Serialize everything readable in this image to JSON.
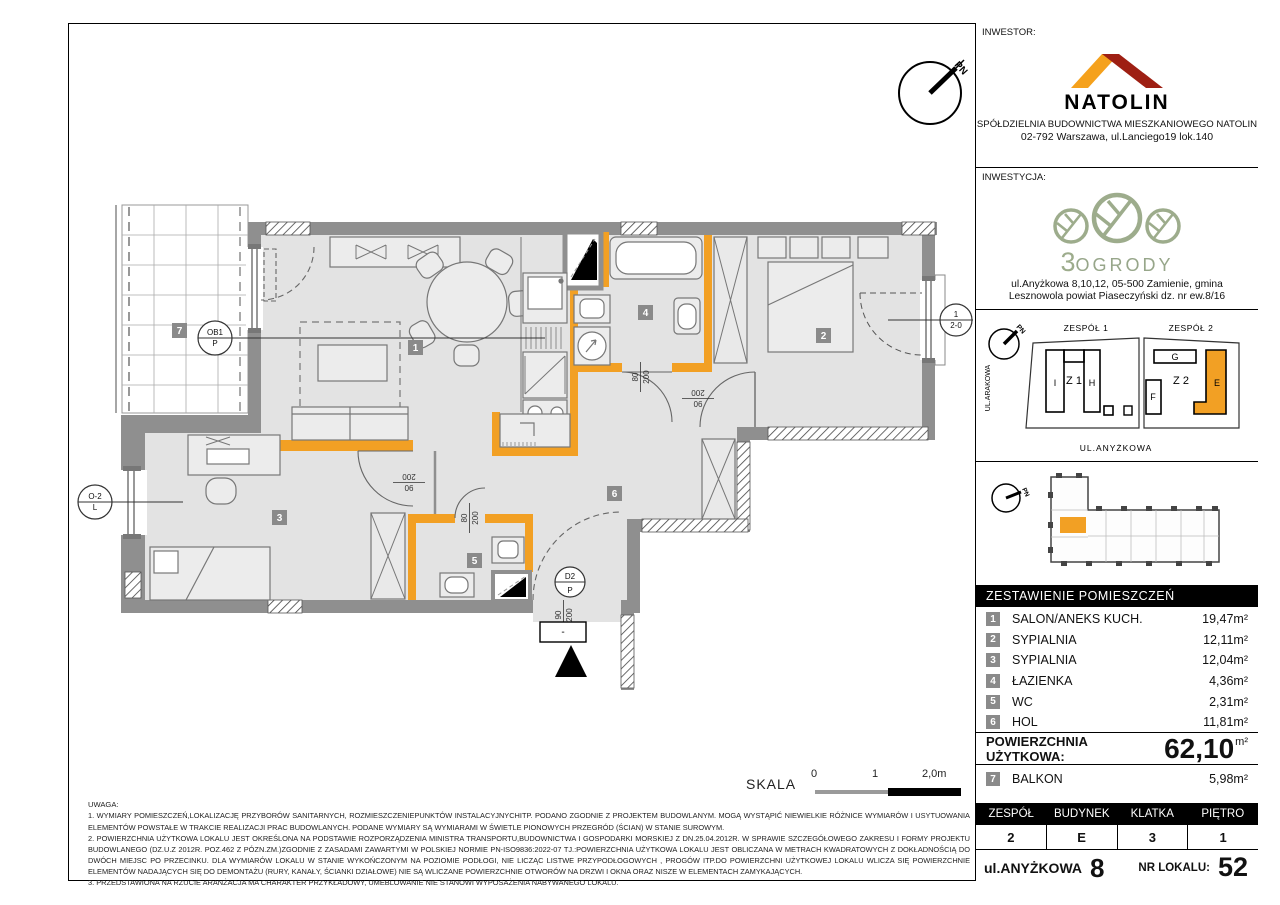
{
  "colors": {
    "accent_orange": "#F2A024",
    "logo_orange": "#F5A11C",
    "logo_red": "#9E1F13",
    "leaf_green": "#9DAC8C",
    "wall_gray": "#8F8F8F",
    "floor_gray": "#E3E3E3",
    "badge_gray": "#8A8A8A"
  },
  "investor": {
    "label": "INWESTOR:",
    "name": "NATOLIN",
    "line1": "SPÓŁDZIELNIA BUDOWNICTWA MIESZKANIOWEGO NATOLIN",
    "line2": "02-792 Warszawa, ul.Lanciego19 lok.140"
  },
  "investment": {
    "label": "INWESTYCJA:",
    "number": "3",
    "name": "OGRODY",
    "line1": "ul.Anyżkowa 8,10,12, 05-500 Zamienie,  gmina",
    "line2": "Lesznowola powiat Piaseczyński dz. nr ew.8/16"
  },
  "siteplan": {
    "north": "PN",
    "zespol1": "ZESPÓŁ 1",
    "zespol2": "ZESPÓŁ 2",
    "street_left": "UL.ARAKOWA",
    "street_bottom": "UL.ANYŻKOWA",
    "b_i": "I",
    "b_z1": "Z 1",
    "b_h": "H",
    "b_g": "G",
    "b_z2": "Z 2",
    "b_f": "F",
    "b_e": "E"
  },
  "rooms": {
    "header": "ZESTAWIENIE POMIESZCZEŃ",
    "items": [
      {
        "no": "1",
        "name": "SALON/ANEKS KUCH.",
        "area": "19,47m²"
      },
      {
        "no": "2",
        "name": "SYPIALNIA",
        "area": "12,11m²"
      },
      {
        "no": "3",
        "name": "SYPIALNIA",
        "area": "12,04m²"
      },
      {
        "no": "4",
        "name": "ŁAZIENKA",
        "area": "4,36m²"
      },
      {
        "no": "5",
        "name": "WC",
        "area": "2,31m²"
      },
      {
        "no": "6",
        "name": "HOL",
        "area": "11,81m²"
      }
    ]
  },
  "usable": {
    "label": "POWIERZCHNIA UŻYTKOWA:",
    "value": "62,10",
    "unit": "m²"
  },
  "balcony_row": {
    "no": "7",
    "name": "BALKON",
    "area": "5,98m²"
  },
  "unit": {
    "headers": [
      "ZESPÓŁ",
      "BUDYNEK",
      "KLATKA",
      "PIĘTRO"
    ],
    "values": [
      "2",
      "E",
      "3",
      "1"
    ]
  },
  "address": {
    "street": "ul.ANYŻKOWA",
    "number": "8",
    "lokal_label": "NR LOKALU:",
    "lokal": "52"
  },
  "scale": {
    "label": "SKALA",
    "t0": "0",
    "t1": "1",
    "t2": "2,0m"
  },
  "notes": {
    "title": "UWAGA:",
    "n1": "1.  WYMIARY POMIESZCZEŃ,LOKALIZACJĘ PRZYBORÓW SANITARNYCH, ROZMIESZCZENIEPUNKTÓW INSTALACYJNYCHITP. PODANO ZGODNIE Z PROJEKTEM BUDOWLANYM. MOGĄ WYSTĄPIĆ NIEWIELKIE RÓŻNICE WYMIARÓW I USYTUOWANIA ELEMENTÓW POWSTAŁE W TRAKCIE REALIZACJI PRAC BUDOWLANYCH. PODANE WYMIARY SĄ WYMIARAMI W ŚWIETLE PIONOWYCH PRZEGRÓD (ŚCIAN) W STANIE SUROWYM.",
    "n2": "2.  POWIERZCHNIA UŻYTKOWA LOKALU JEST OKREŚLONA NA PODSTAWIE ROZPORZĄDZENIA MINISTRA TRANSPORTU,BUDOWNICTWA I GOSPODARKI MORSKIEJ Z DN.25.04.2012R. W SPRAWIE SZCZEGÓŁOWEGO ZAKRESU I FORMY PROJEKTU BUDOWLANEGO (DZ.U.Z 2012R. POZ.462 Z PÓZN.ZM.)ZGODNIE Z ZASADAMI ZAWARTYMI W POLSKIEJ NORMIE PN-ISO9836:2022-07 TJ.:POWIERZCHNIA UŻYTKOWA LOKALU JEST OBLICZANA W METRACH KWADRATOWYCH Z DOKŁADNOŚCIĄ DO DWÓCH MIEJSC PO PRZECINKU. DLA WYMIARÓW LOKALU W STANIE WYKOŃCZONYM NA POZIOMIE PODŁOGI, NIE LICZĄC LISTWE PRZYPODŁOGOWYCH , PROGÓW ITP.DO POWIERZCHNI UŻYTKOWEJ LOKALU WLICZA SIĘ POWIERZCHNIE ELEMENTÓW NADAJĄCYCH SIĘ DO DEMONTAŻU (RURY, KANAŁY, ŚCIANKI DZIAŁOWE) NIE SĄ WLICZANE POWIERZCHNIE OTWORÓW NA DRZWI I OKNA ORAZ NISZE W ELEMENTACH ZAMYKAJĄCYCH.",
    "n3": "3.  PRZEDSTAWIONA NA RZUCIE ARANŻACJA MA CHARAKTER PRZYKŁADOWY, UMEBLOWANIE NIE STANOWI WYPOSAŻENIA NABYWANEGO LOKALU."
  },
  "plan": {
    "north": "PN",
    "badges": [
      "1",
      "2",
      "3",
      "4",
      "5",
      "6",
      "7"
    ],
    "dim_90_200_a": "90",
    "dim_90_200_b": "200",
    "dim_80_200_a": "80",
    "dim_80_200_b": "200",
    "m_ob1_t": "OB1",
    "m_ob1_b": "P",
    "m_o2_t": "O-2",
    "m_o2_b": "L",
    "m_r_t": "1",
    "m_r_b": "2-0",
    "m_d2_t": "D2",
    "m_d2_b": "P",
    "entry_minus": "-"
  }
}
